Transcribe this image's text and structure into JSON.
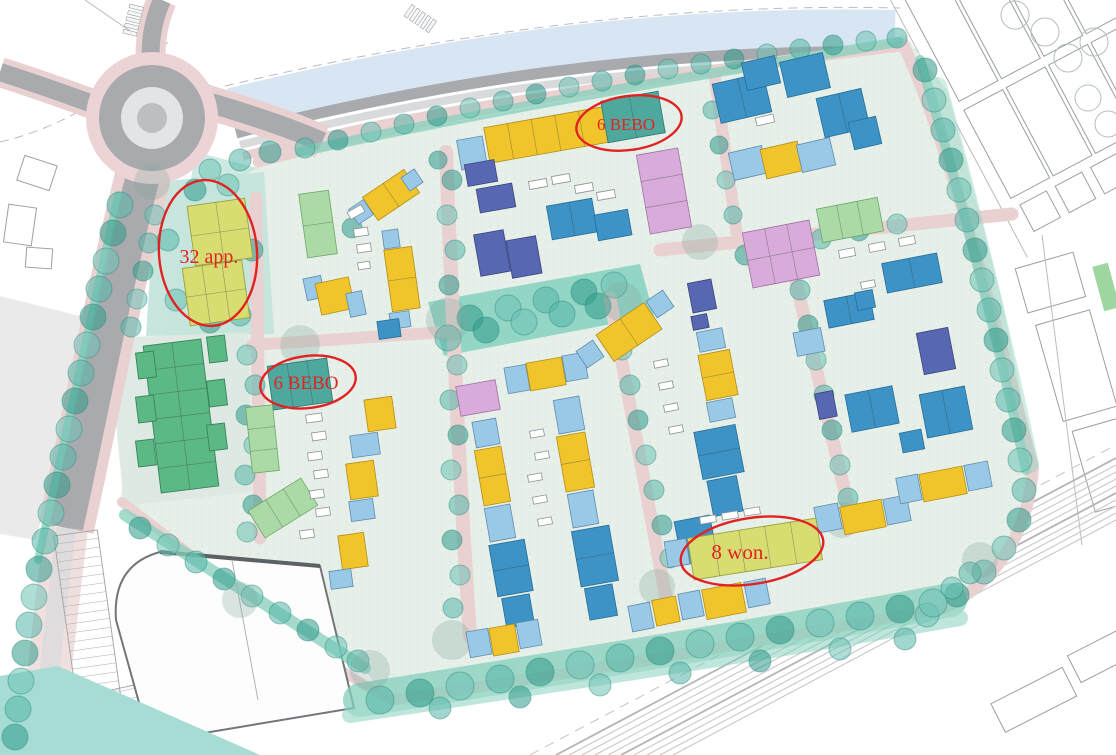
{
  "map": {
    "annotations": [
      {
        "id": "bebo-top",
        "label": "6 BEBO"
      },
      {
        "id": "app-left",
        "label": "32 app."
      },
      {
        "id": "bebo-mid",
        "label": "6 BEBO"
      },
      {
        "id": "won-bottom",
        "label": "8 won."
      }
    ]
  },
  "colors": {
    "annotation_red": "#e22222",
    "water": "#a6dcd4",
    "canal": "#d8e5f2",
    "road_gray": "#a9aaae",
    "road_light": "#d9dadc",
    "path_pink": "#e9d1d2",
    "ground_mint": "#e7efe9",
    "lawn_teal": "#c2e3da",
    "park_green": "#84d1c0",
    "hedge_green": "#85cfbc",
    "tree_teal": "#4fb3a4",
    "building_light_blue": "#9ac9e8",
    "building_blue": "#3e93c6",
    "building_indigo": "#5767b2",
    "building_yellow": "#f2c42c",
    "building_yellow_green": "#d8dd72",
    "building_teal": "#4fa89e",
    "building_green": "#5cb884",
    "building_light_green": "#abdaa6",
    "building_mauve": "#d9abda",
    "context_line": "#9aa0a4"
  }
}
